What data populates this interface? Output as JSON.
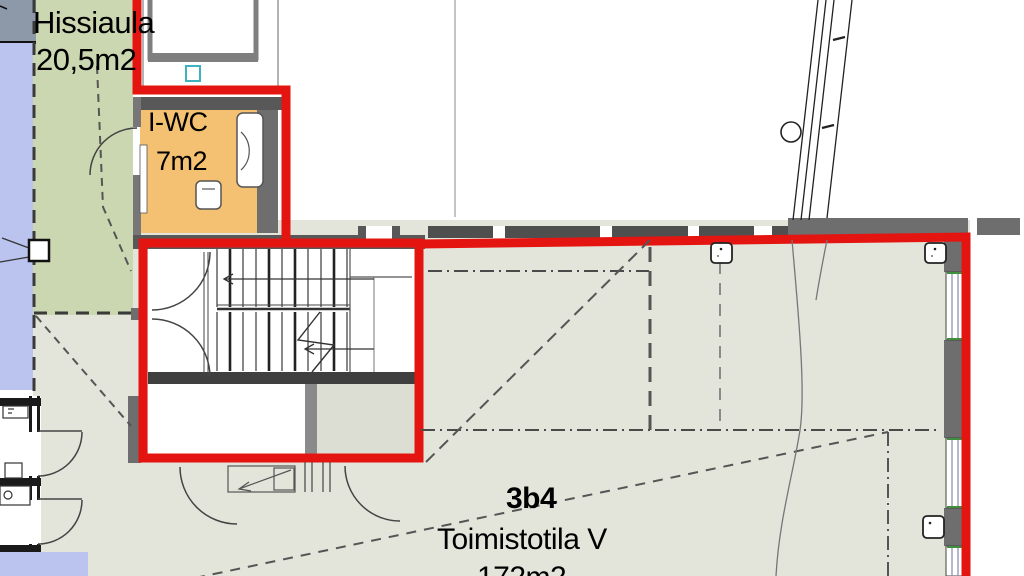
{
  "rooms": {
    "hissiaula": {
      "name": "Hissiaula",
      "area": "20,5m2"
    },
    "iwc": {
      "name": "I-WC",
      "area": "7m2"
    },
    "office": {
      "code": "3b4",
      "name": "Toimistotila V",
      "area": "172m2"
    }
  },
  "colors": {
    "selection_red": "#e41511",
    "wc_fill": "#f4c173",
    "hissiaula_fill": "#cbd7b0",
    "corridor_fill": "#bac4ee",
    "floor_fill": "#e3e4da",
    "stair_lower_room_fill": "#dcddd3",
    "wall_dark": "#4f4f4f",
    "wall_medium": "#6e6e6e",
    "window_mullion": "#8888aa",
    "window_frame_green": "#3f8f3f",
    "elevator_marker_cyan": "#3fb2c0"
  }
}
